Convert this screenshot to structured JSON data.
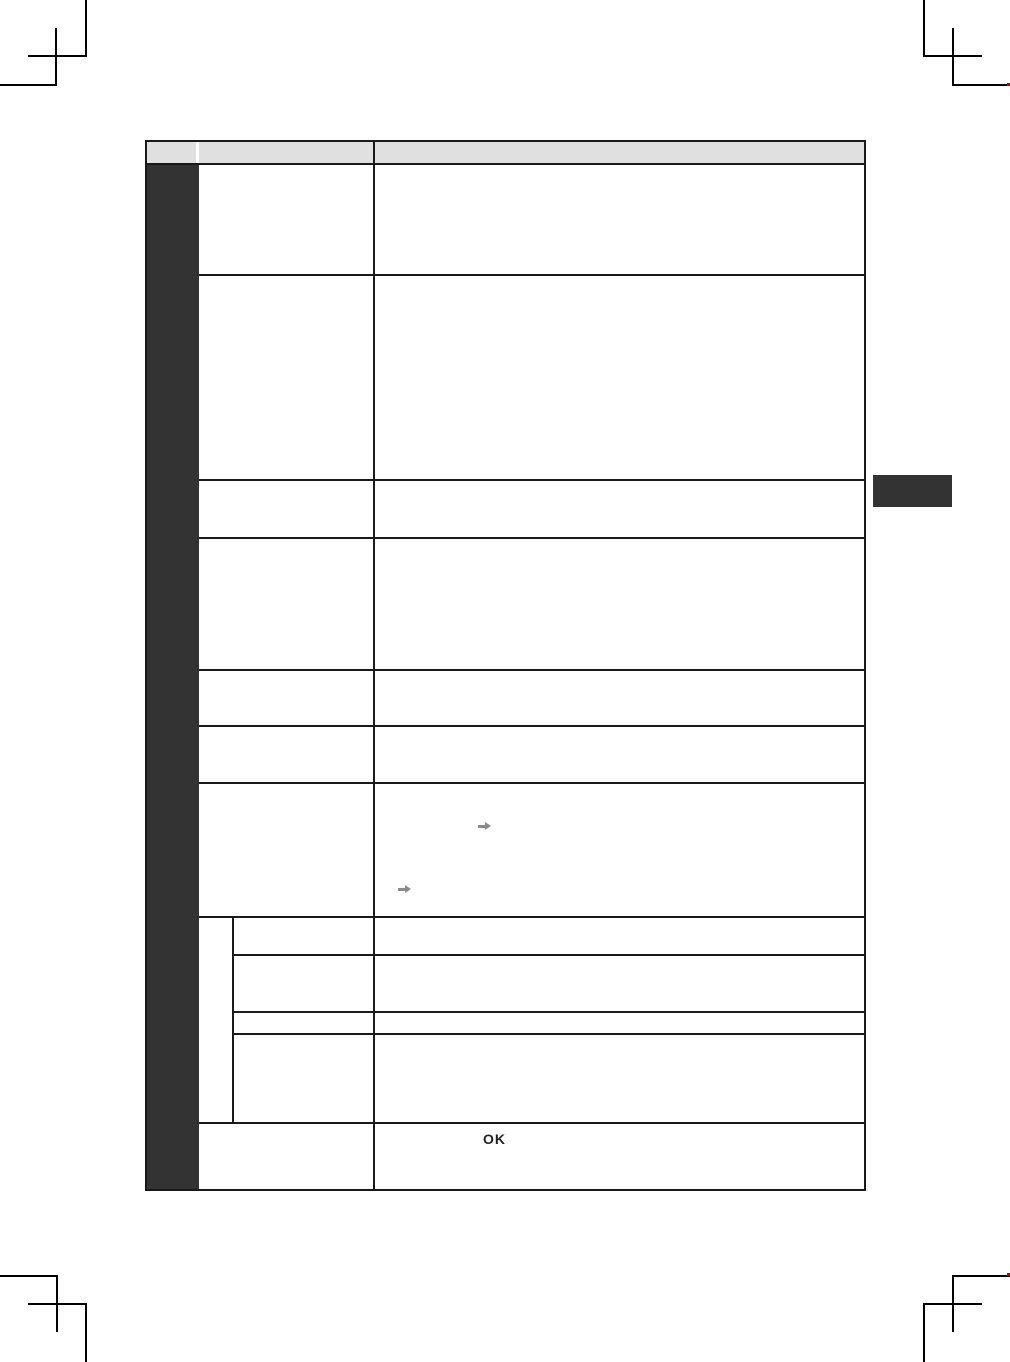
{
  "page": {
    "background": "#ffffff"
  },
  "colors": {
    "table_border": "#1a1a1a",
    "header_fill": "#e0e0e0",
    "chapter_bar": "#333333",
    "arrow_color": "#8a8a8a",
    "ok_color": "#1f1f1f",
    "crop_mark": "#000000",
    "registration_dot": "#c00000"
  },
  "table": {
    "header_cells": [
      "",
      "",
      ""
    ],
    "ok_label": "OK"
  },
  "icons": {
    "arrows": [
      "right-arrow-icon",
      "right-arrow-icon"
    ]
  }
}
